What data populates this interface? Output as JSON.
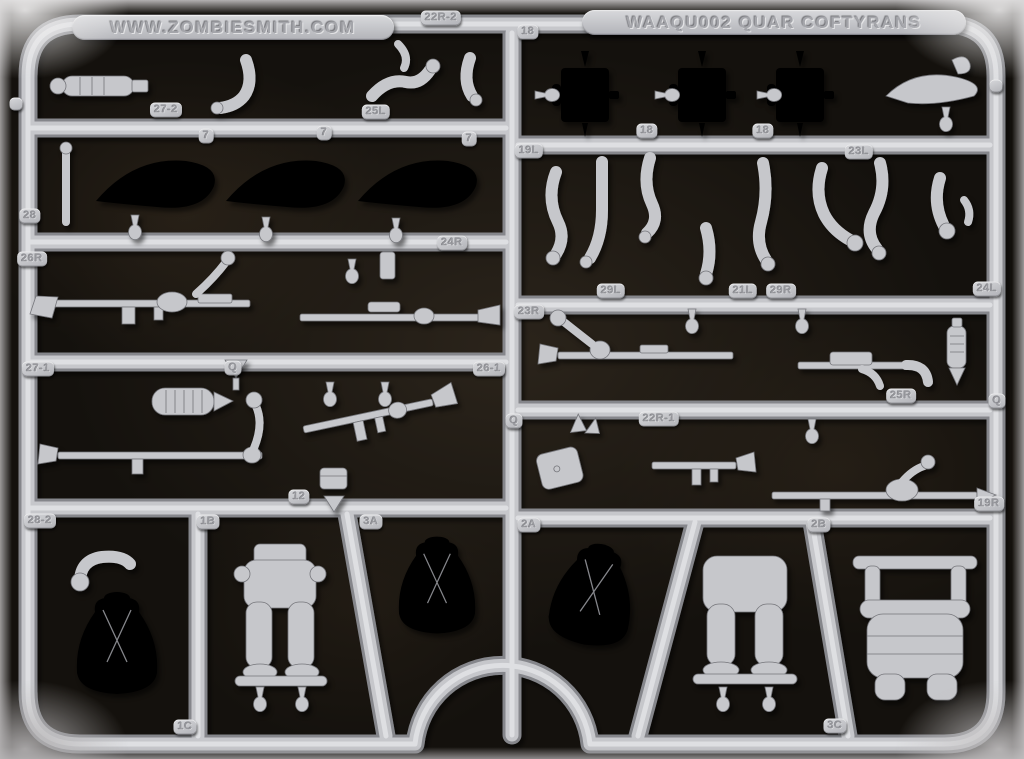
{
  "photo": {
    "background_color": "#14110d",
    "plastic_color": "#c6c7cb",
    "edge_color": "#cfcdce"
  },
  "labels": {
    "brand": "WWW.ZOMBIESMITH.COM",
    "product": "WAAQU002 QUAR COFTYRANS"
  },
  "part_tags": [
    {
      "text": "22R-2",
      "x": 441,
      "y": 18
    },
    {
      "text": "",
      "x": 16,
      "y": 104
    },
    {
      "text": "27-2",
      "x": 166,
      "y": 110
    },
    {
      "text": "25L",
      "x": 376,
      "y": 112
    },
    {
      "text": "7",
      "x": 206,
      "y": 136
    },
    {
      "text": "7",
      "x": 324,
      "y": 133
    },
    {
      "text": "7",
      "x": 469,
      "y": 139
    },
    {
      "text": "28",
      "x": 30,
      "y": 216
    },
    {
      "text": "26R",
      "x": 32,
      "y": 259
    },
    {
      "text": "24R",
      "x": 452,
      "y": 243
    },
    {
      "text": "27-1",
      "x": 38,
      "y": 369
    },
    {
      "text": "Q",
      "x": 233,
      "y": 368
    },
    {
      "text": "26-1",
      "x": 489,
      "y": 369
    },
    {
      "text": "12",
      "x": 299,
      "y": 497
    },
    {
      "text": "28-2",
      "x": 40,
      "y": 521
    },
    {
      "text": "1B",
      "x": 208,
      "y": 522
    },
    {
      "text": "3A",
      "x": 371,
      "y": 522
    },
    {
      "text": "1C",
      "x": 185,
      "y": 727
    },
    {
      "text": "18",
      "x": 528,
      "y": 32
    },
    {
      "text": "18",
      "x": 647,
      "y": 131
    },
    {
      "text": "18",
      "x": 763,
      "y": 131
    },
    {
      "text": "",
      "x": 996,
      "y": 86
    },
    {
      "text": "19L",
      "x": 529,
      "y": 151
    },
    {
      "text": "23L",
      "x": 859,
      "y": 152
    },
    {
      "text": "29L",
      "x": 611,
      "y": 291
    },
    {
      "text": "21L",
      "x": 743,
      "y": 291
    },
    {
      "text": "29R",
      "x": 781,
      "y": 291
    },
    {
      "text": "24L",
      "x": 987,
      "y": 289
    },
    {
      "text": "23R",
      "x": 529,
      "y": 312
    },
    {
      "text": "25R",
      "x": 901,
      "y": 396
    },
    {
      "text": "Q",
      "x": 997,
      "y": 401
    },
    {
      "text": "Q",
      "x": 514,
      "y": 421
    },
    {
      "text": "22R-1",
      "x": 659,
      "y": 419
    },
    {
      "text": "19R",
      "x": 989,
      "y": 504
    },
    {
      "text": "2A",
      "x": 529,
      "y": 525
    },
    {
      "text": "2B",
      "x": 819,
      "y": 525
    },
    {
      "text": "3C",
      "x": 835,
      "y": 726
    }
  ]
}
